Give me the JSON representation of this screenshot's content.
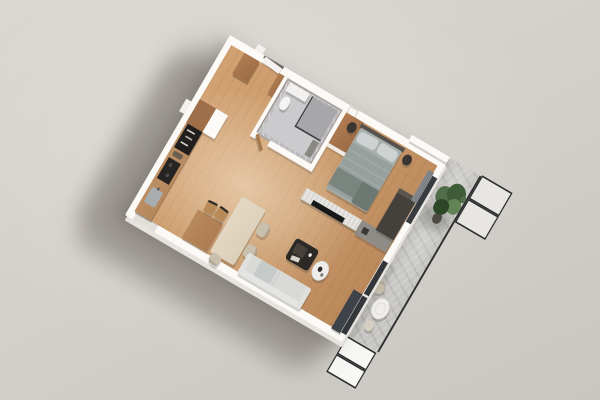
{
  "scene": {
    "title": "3D isometric render of a one-bedroom apartment floor plan",
    "view": "top-down axonometric, rotated, on plain grey studio backdrop",
    "rooms": [
      {
        "name": "open living / dining / kitchen",
        "floor": "light oak planks",
        "objects": [
          "L kitchen counter with wood top",
          "black open shelf unit",
          "dark cooktop",
          "steel sink",
          "white structural pillar",
          "wood wall desk",
          "two dark-frame chairs",
          "light wood dining table",
          "three beige chairs",
          "light grey sofa",
          "dark coffee table with tray",
          "white round side table"
        ]
      },
      {
        "name": "bedroom",
        "floor": "light oak planks",
        "objects": [
          "double bed with grey bedding and two pillows",
          "dark headboard",
          "two dark round nightstands",
          "dark dresser",
          "grey curtain",
          "white slatted TV wall with black TV",
          "grey media console",
          "wood wardrobe"
        ]
      },
      {
        "name": "bathroom",
        "floor": "grey marble",
        "objects": [
          "glass shower with dark frame",
          "white sink counter",
          "white toilet",
          "open wood door"
        ]
      },
      {
        "name": "entry hallway",
        "floor": "light oak planks",
        "objects": [
          "white entry door",
          "two wood-top wardrobes",
          "service duct"
        ]
      },
      {
        "name": "balcony",
        "floor": "concrete slab",
        "objects": [
          "green potted plant",
          "white round cafe table",
          "beige chair",
          "beige stool",
          "glass balustrade panels with dark frames",
          "dark sliding glass doors"
        ]
      }
    ]
  },
  "palette": {
    "background_hint": "#d3cfca",
    "wall": "#fbfaf7",
    "wood_floor": "#c9996a",
    "marble": "#b8b6b8",
    "marble_floor": "#cbcbcd",
    "concrete": "#c7c6c3",
    "counter_wood": "#b5875c",
    "cabinet_dark": "#211f1e",
    "sofa": "#d9dad7",
    "bed_duvet": "#97a09c",
    "bed_pillow": "#ced2d2",
    "tv": "#17181a",
    "tv_wall": "#e6e4e0",
    "dining_table": "#dccfb9",
    "desk_wood": "#ad7c52",
    "chair_beige": "#c9bfad",
    "wardrobe_wood": "#9c6b45",
    "plant_green": "#4a6a42",
    "plant_pot": "#4e4b47",
    "railing": "#2c2d2f",
    "glass_door": "#33373b",
    "coffee_table": "#2b2825",
    "side_table": "#edecea",
    "balcony_table": "#f0efec",
    "console": "#8f8c87",
    "dresser": "#44403c",
    "curtain": "#767c80"
  }
}
